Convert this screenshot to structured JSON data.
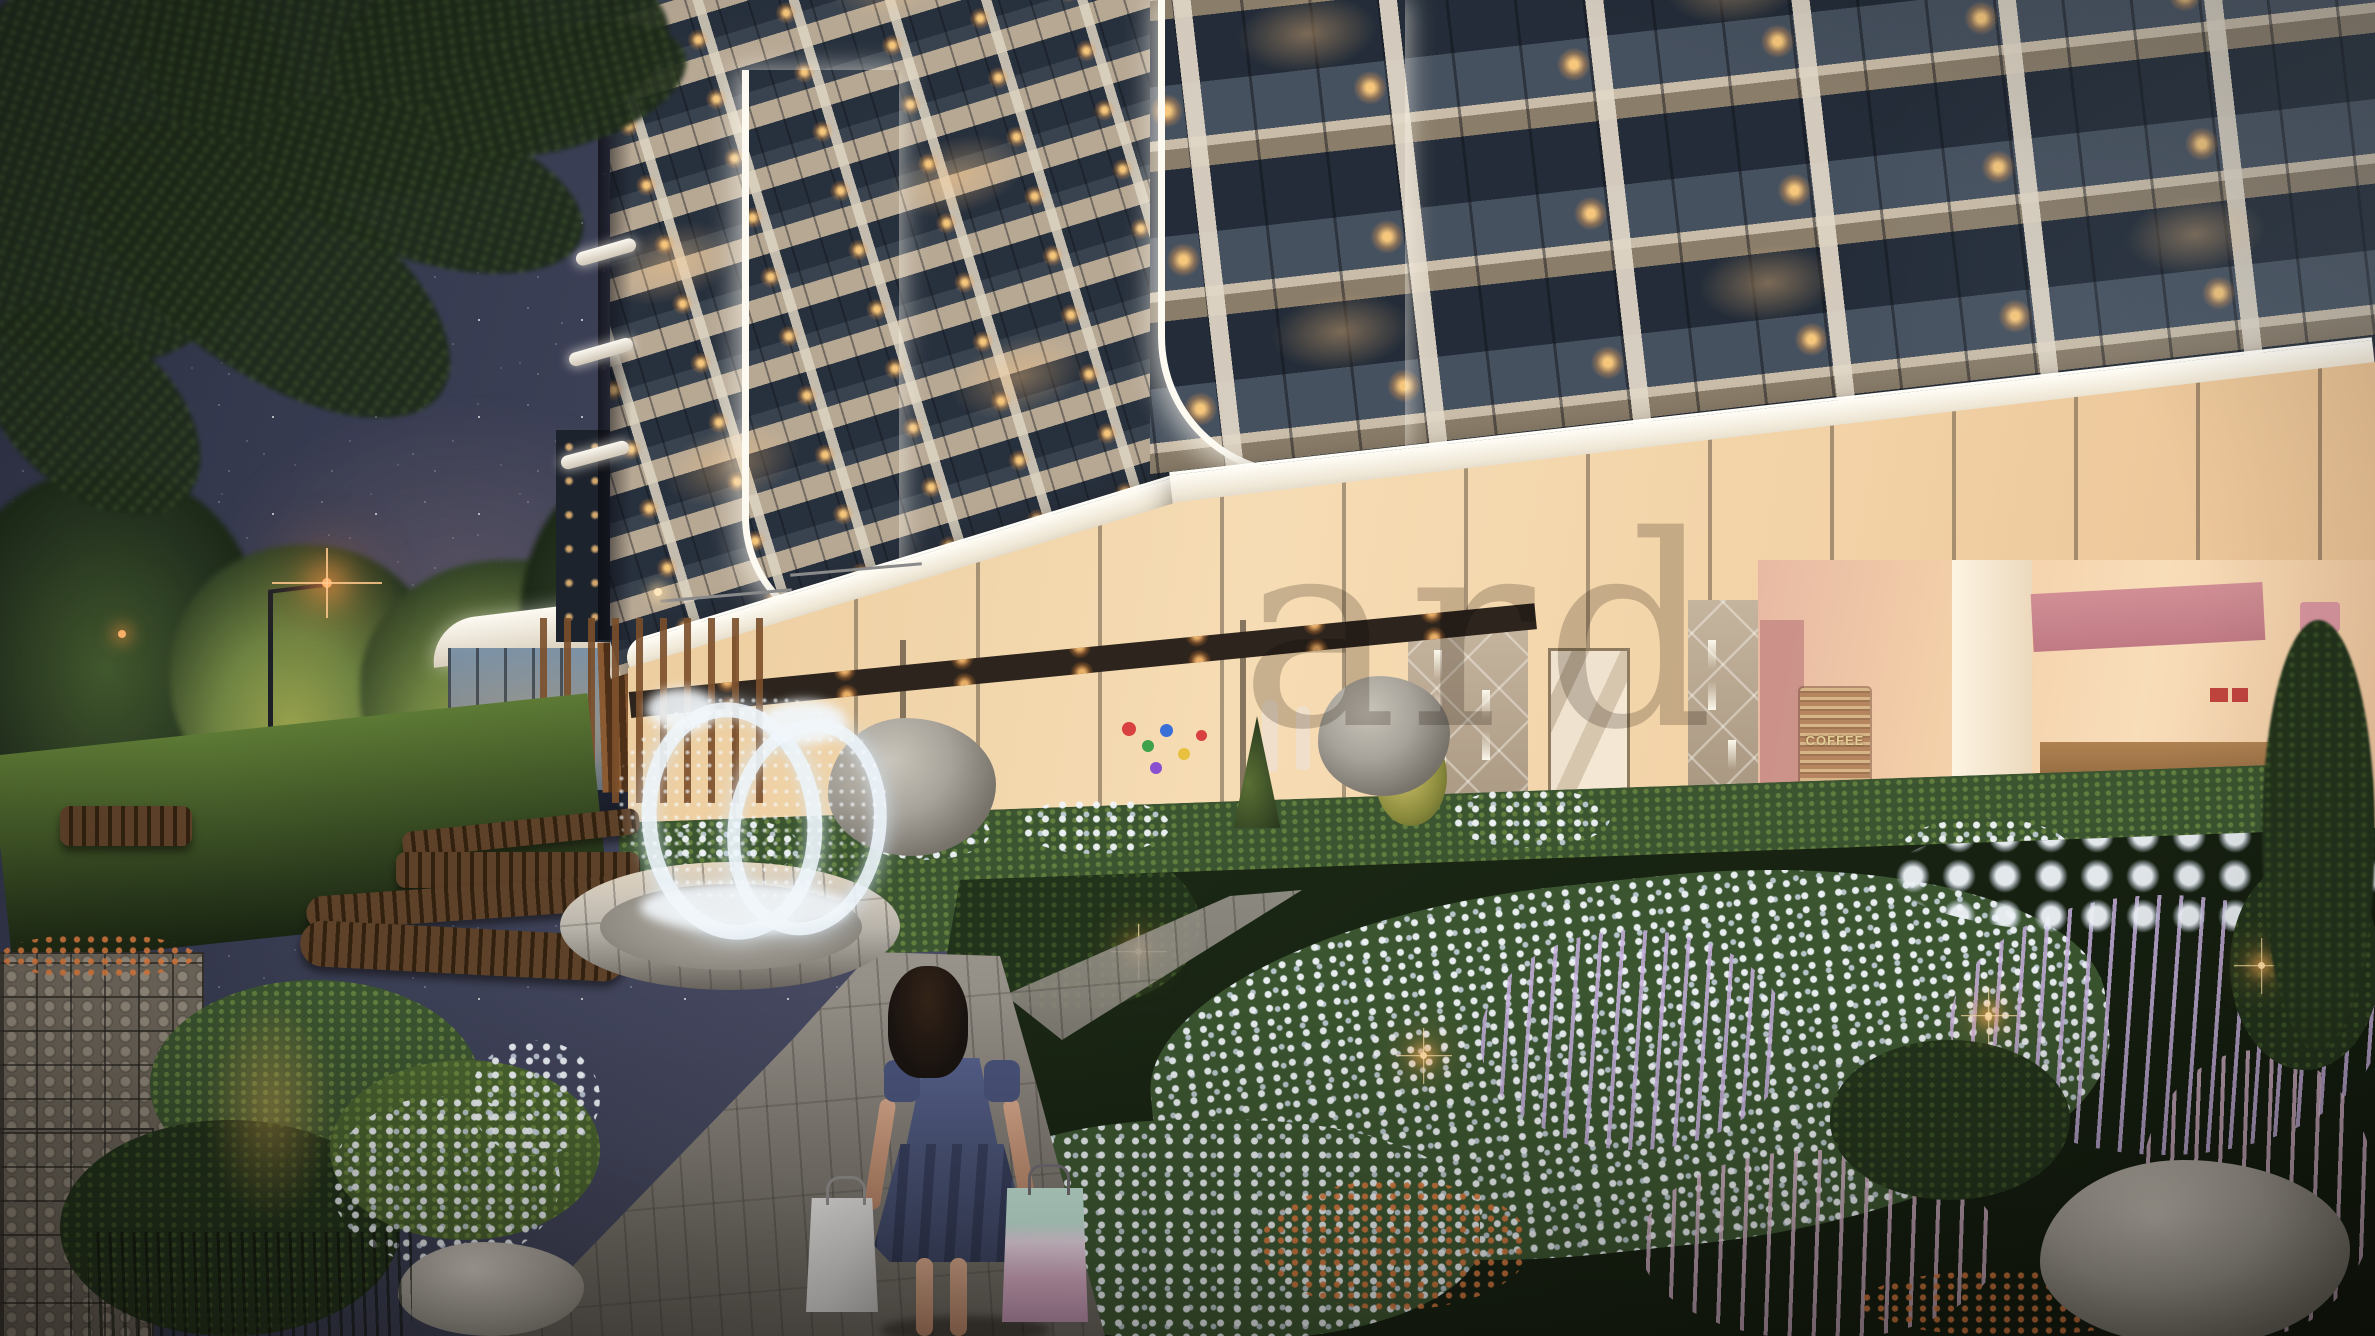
{
  "watermark": {
    "visible_text": "ard"
  },
  "cafe": {
    "wall_art_text": "COFFEE"
  },
  "colors": {
    "sky_top": "#2e3246",
    "sky_glow": "#6e5f74",
    "foliage_dark": "#24331f",
    "foliage_lit": "#6f8442",
    "foliage_warm": "#98a14c",
    "tower_slab": "#b7a894",
    "tower_window_dark": "#232c38",
    "led_white": "#fdfaf2",
    "lamp_warm": "#ffb36b",
    "storefront_warm": "#f6dcb4",
    "cafe_pink": "#c78b85",
    "coffee_art_text": "#e3cf96",
    "quilt_wall": "#b3a28d",
    "hedge_green": "#3b5530",
    "lavender": "#c3aed8",
    "orange_flower": "#d4763f",
    "rock_light": "#a8a39a",
    "rock_dark": "#5c574f",
    "path_light": "#b8b3aa",
    "path_shadow": "#8d8880",
    "girl_hair": "#191310",
    "girl_dress": "#4a5478",
    "bag_gray": "#d6d5d3",
    "bag_pink": "#d3a8c0",
    "bag_mint": "#bfdfd3",
    "fountain_ring": "#ecf4fb",
    "watermark": "rgba(110,100,92,0.33)"
  }
}
